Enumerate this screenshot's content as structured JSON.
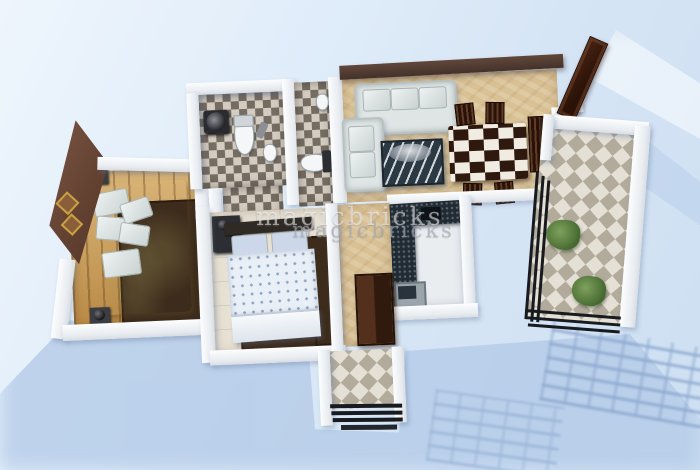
{
  "image_type": "3d-isometric-floor-plan-render",
  "watermark": {
    "line1": "magicbricks",
    "line2": "magicbricks"
  },
  "palette": {
    "background_blue": "#dce9f7",
    "cast_shadow": "#b4cbe8",
    "wall_white": "#f3f5f7",
    "accent_wall_brown": "#6b4536",
    "wood_floor": "#c6964f",
    "marble_floor": "#d9c194",
    "bath_tile_dark": "#756c62",
    "bath_tile_light": "#d4ccc0",
    "kitchen_granite": "#202b34",
    "sofa_grey": "#dfe5e5",
    "master_bed_cream": "#ece4cf",
    "second_bed_blue": "#e9eff6",
    "rug_brown": "#3d2c1c",
    "dining_wood": "#2f180d",
    "entry_door_brown": "#35190e",
    "terrace_tile": "#b2aa9b",
    "plant_green": "#4c6f35",
    "railing_black": "#171b20"
  },
  "rooms": [
    {
      "name": "master-bedroom",
      "furniture": [
        "double-bed-cream",
        "pillows",
        "area-rug",
        "nightstand-lamp-top",
        "nightstand-lamp-bottom",
        "brown-accent-wall",
        "diamond-wall-art",
        "wood-plank-floor"
      ]
    },
    {
      "name": "bathroom-1",
      "furniture": [
        "toilet",
        "washing-machine",
        "shower-head",
        "checkered-tile-floor"
      ]
    },
    {
      "name": "bathroom-2",
      "furniture": [
        "toilet",
        "wash-basin",
        "checkered-tile-floor"
      ]
    },
    {
      "name": "living-room",
      "furniture": [
        "three-seater-sofa",
        "two-seater-sofa",
        "patterned-area-rug",
        "brown-feature-wall",
        "marble-floor"
      ]
    },
    {
      "name": "dining-area",
      "furniture": [
        "dining-table-dark-wood",
        "placemats",
        "chair-top-1",
        "chair-top-2",
        "chair-bottom-1",
        "chair-bottom-2",
        "head-chair",
        "tall-cabinet"
      ]
    },
    {
      "name": "kitchen",
      "furniture": [
        "l-shaped-granite-counter",
        "hob",
        "sink"
      ]
    },
    {
      "name": "corridor",
      "furniture": [
        "wardrobe-dark-wood",
        "marble-floor"
      ]
    },
    {
      "name": "second-bedroom",
      "furniture": [
        "double-bed-blue",
        "pillows",
        "dresser-with-lamp",
        "l-shaped-dark-rug"
      ]
    },
    {
      "name": "terrace-right",
      "furniture": [
        "diamond-tile-floor",
        "plant-1",
        "plant-2",
        "metal-railing",
        "parapet-walls"
      ]
    },
    {
      "name": "rear-balcony",
      "furniture": [
        "diamond-tile-floor",
        "metal-railing"
      ]
    },
    {
      "name": "entrance",
      "furniture": [
        "open-wooden-door",
        "threshold-step"
      ]
    }
  ],
  "environment": {
    "backdrop": "light-blue gradient",
    "shadows": [
      "building-cast-shadow-bottom",
      "railing-lattice-shadow-right",
      "railing-lattice-shadow-bottom",
      "diagonal-light-band-top-right"
    ]
  }
}
